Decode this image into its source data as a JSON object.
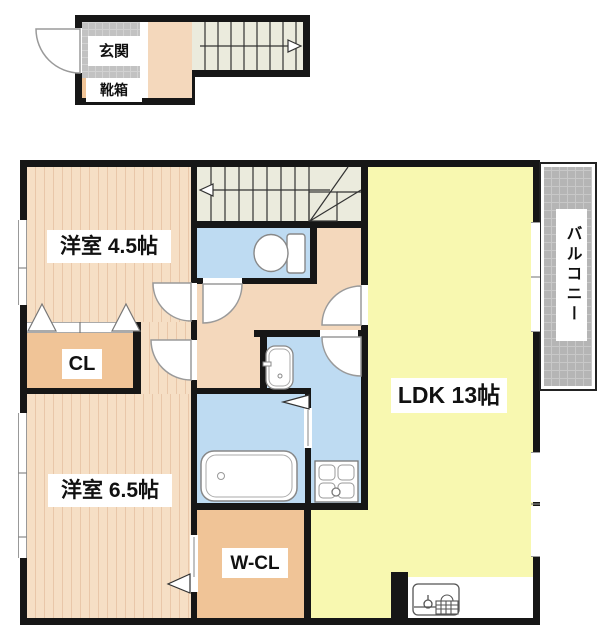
{
  "floorplan": {
    "type": "japanese-apartment-floor-plan",
    "first_floor_block": {
      "genkan": "玄関",
      "kutsubako": "靴箱",
      "stairs_direction": "up-to-right"
    },
    "second_floor": {
      "room_45": "洋室 4.5帖",
      "closet": "CL",
      "room_65": "洋室 6.5帖",
      "walkin_closet": "W-CL",
      "ldk": "LDK 13帖",
      "balcony": "バルコニー",
      "stairs_direction": "down-to-left"
    },
    "fixtures": [
      "toilet",
      "washbasin",
      "bathtub",
      "washing-machine-pan",
      "kitchen-sink",
      "gas-stove",
      "entrance-door",
      "room-doors",
      "sliding-doors",
      "folding-closet-doors"
    ],
    "colors": {
      "wall": "#161616",
      "wood_floor": "#f6dfc5",
      "wood_stripe": "#e9c7a9",
      "hallway_floor": "#f4d8bc",
      "ldk_floor": "#f8f8b0",
      "wet_area": "#bedbf2",
      "closet": "#f0c497",
      "stairs": "#ebebdd",
      "entrance_tile": "#c2c2c2",
      "balcony_tile": "#b5b5b5"
    }
  }
}
